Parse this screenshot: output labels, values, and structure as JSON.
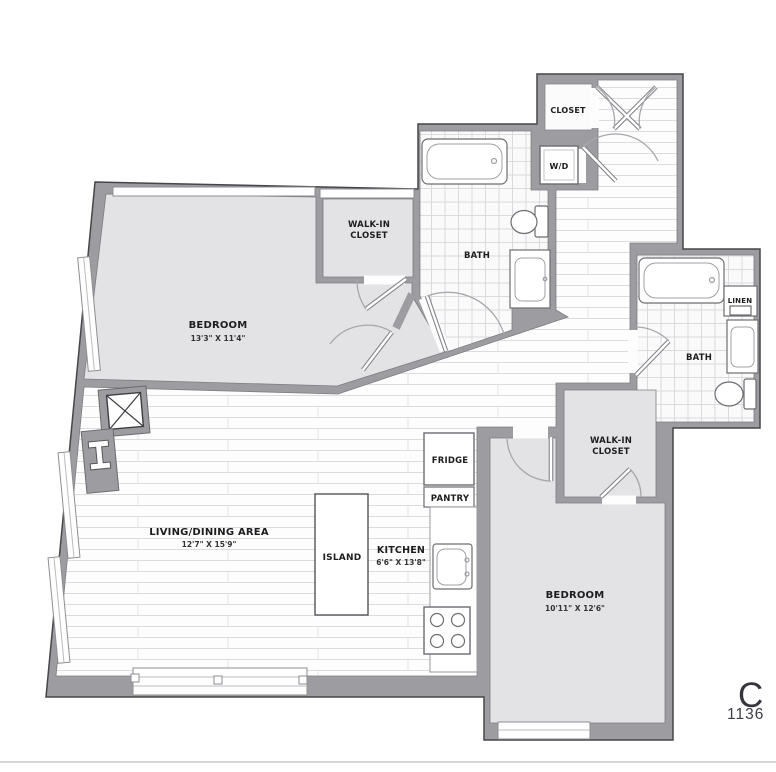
{
  "floorplan": {
    "bedroom1": {
      "name": "BEDROOM",
      "dims": "13'3\" X 11'4\""
    },
    "walk_in_closet1": {
      "line1": "WALK-IN",
      "line2": "CLOSET"
    },
    "bath1": {
      "name": "BATH"
    },
    "entry_closet": {
      "name": "CLOSET"
    },
    "washer_dryer": {
      "name": "W/D"
    },
    "bath2": {
      "name": "BATH"
    },
    "linen": {
      "name": "LINEN"
    },
    "walk_in_closet2": {
      "line1": "WALK-IN",
      "line2": "CLOSET"
    },
    "living": {
      "name": "LIVING/DINING AREA",
      "dims": "12'7\" X 15'9\""
    },
    "kitchen": {
      "name": "KITCHEN",
      "dims": "6'6\" X 13'8\""
    },
    "island": {
      "name": "ISLAND"
    },
    "fridge": {
      "name": "FRIDGE"
    },
    "pantry": {
      "name": "PANTRY"
    },
    "bedroom2": {
      "name": "BEDROOM",
      "dims": "10'11\" X 12'6\""
    }
  },
  "branding": {
    "title_partial": "C",
    "subtitle_partial": "1136"
  },
  "colors": {
    "wall": "#9d9da1",
    "room": "#e3e3e5",
    "floor_line": "#d8d8da"
  }
}
